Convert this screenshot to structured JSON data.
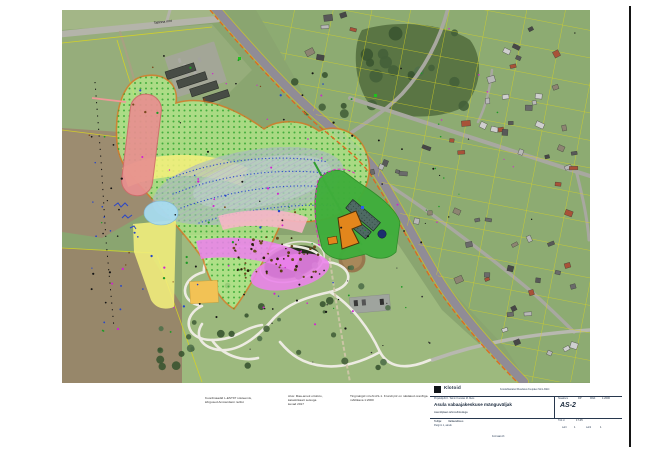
{
  "map": {
    "road_label": "Tallinna mnt"
  },
  "palette": {
    "zone-green": "#b5ef8b",
    "zone-green-stroke": "#e0771c",
    "zone-yellow": "#f3ef7c",
    "zone-salmon": "#e89090",
    "zone-gray": "#a9bcc2",
    "zone-cyan": "#a8dcf2",
    "zone-pink": "#f6b6c6",
    "zone-magenta": "#ec82ec",
    "site-green": "#3fae3b",
    "site-orange": "#e2861c",
    "parcel-yellow": "#d8d422",
    "boundary-orange": "#e0641e",
    "dots-blue": "#2848cc"
  },
  "notes": {
    "n1": [
      "Koordinaadid L-EST97 süsteemis,",
      "kõrgused Amsterdami nullist"
    ],
    "n2": [
      "Alus: Maa-ameti ortofoto,",
      "katastrikaart seisuga",
      "kevad 2017"
    ],
    "n3": [
      "Tingmärgid vt leht AS-1. Krundi piir on näidatud oranžiga.",
      "mõõtkava 1:2000"
    ]
  },
  "title_block": {
    "logo_text": "Klotoid",
    "approvals": "Kooskõlastatud    Muudatus    Kuupäev    Nimi    Allkiri",
    "row1": "Projektijuht  K. Tamm        Koostas  M. Mets",
    "project_name": "Asula vabaajakeskuse mänguväljak",
    "drawing_name": "Asendiplaan tehnovõrkudega",
    "stage_label": "Staadium",
    "stage_value": "DP",
    "scale_label": "Mõõt",
    "scale_value": "1:2000",
    "sheet_code": "AS-2",
    "client_label": "Tellija:",
    "client_value": "Vallavalitsus",
    "client_addr": "Pargi tn 1, alevik",
    "worknr_label": "Töö nr",
    "worknr_value": "17-05",
    "sheet_label": "Leht",
    "sheet_value": "1",
    "sheets_label": "Lehti",
    "sheets_value": "1",
    "format_note": "Formaat A3"
  },
  "decor": {
    "houses": {
      "colors": [
        "#6a6a6a",
        "#585858",
        "#a85238",
        "#cfcfcf",
        "#8d8472",
        "#b8b8b8",
        "#474747"
      ],
      "min_w": 4,
      "var_w": 5,
      "min_h": 3.2,
      "var_h": 3.4,
      "zones": [
        {
          "x": 418,
          "y": 8,
          "w": 103,
          "h": 88,
          "n": 13
        },
        {
          "x": 348,
          "y": 108,
          "w": 172,
          "h": 110,
          "n": 24
        },
        {
          "x": 390,
          "y": 226,
          "w": 128,
          "h": 78,
          "n": 13
        },
        {
          "x": 240,
          "y": 2,
          "w": 55,
          "h": 46,
          "n": 6
        },
        {
          "x": 300,
          "y": 120,
          "w": 44,
          "h": 44,
          "n": 5
        },
        {
          "x": 435,
          "y": 292,
          "w": 85,
          "h": 55,
          "n": 8
        }
      ]
    },
    "cars": {
      "colors": [
        "#e8e8e8",
        "#c6cad0",
        "#93989f"
      ],
      "zones": [
        {
          "x": 114,
          "y": 46,
          "w": 22,
          "h": 40,
          "n": 7
        }
      ],
      "w": 2.6,
      "h": 4.6,
      "rot": -18
    },
    "trees": {
      "colors": [
        "#44603a",
        "#3a5531",
        "#50704a"
      ],
      "zones": [
        {
          "x": 135,
          "y": 240,
          "w": 200,
          "h": 122,
          "n": 24,
          "rmin": 1.5,
          "rmax": 4
        },
        {
          "x": 88,
          "y": 306,
          "w": 48,
          "h": 62,
          "n": 11,
          "rmin": 2,
          "rmax": 4.5
        },
        {
          "x": 300,
          "y": 16,
          "w": 114,
          "h": 88,
          "n": 15,
          "rmin": 3,
          "rmax": 7
        },
        {
          "x": 228,
          "y": 60,
          "w": 60,
          "h": 60,
          "n": 6,
          "rmin": 2,
          "rmax": 5
        }
      ]
    },
    "dots": {
      "zones": [
        {
          "x": 25,
          "y": 45,
          "w": 268,
          "h": 278,
          "n": 110,
          "rmin": 0.6,
          "rmax": 1.2,
          "colors": [
            "#151515",
            "#d21fd2",
            "#1f9a25",
            "#2646c8",
            "#7a4a1e",
            "#d21fd2",
            "#151515",
            "#1f9a25"
          ]
        },
        {
          "x": 170,
          "y": 226,
          "w": 88,
          "h": 42,
          "n": 55,
          "rmin": 0.7,
          "rmax": 1.5,
          "colors": [
            "#6b4a1e",
            "#5a3d14",
            "#2a1d08"
          ]
        },
        {
          "x": 298,
          "y": 118,
          "w": 85,
          "h": 125,
          "n": 14,
          "rmin": 0.6,
          "rmax": 1,
          "colors": [
            "#111111",
            "#d21fd2",
            "#1f9a25"
          ]
        },
        {
          "x": 150,
          "y": 252,
          "w": 240,
          "h": 105,
          "n": 16,
          "rmin": 0.5,
          "rmax": 0.9,
          "colors": [
            "#141414",
            "#333333"
          ]
        },
        {
          "x": 28,
          "y": 178,
          "w": 62,
          "h": 140,
          "n": 16,
          "rmin": 0.6,
          "rmax": 1.1,
          "colors": [
            "#141414",
            "#2646c8"
          ]
        },
        {
          "x": 330,
          "y": 0,
          "w": 195,
          "h": 300,
          "n": 20,
          "rmin": 0.5,
          "rmax": 0.9,
          "colors": [
            "#141414",
            "#1f9a25",
            "#d21fd2"
          ]
        }
      ]
    }
  }
}
